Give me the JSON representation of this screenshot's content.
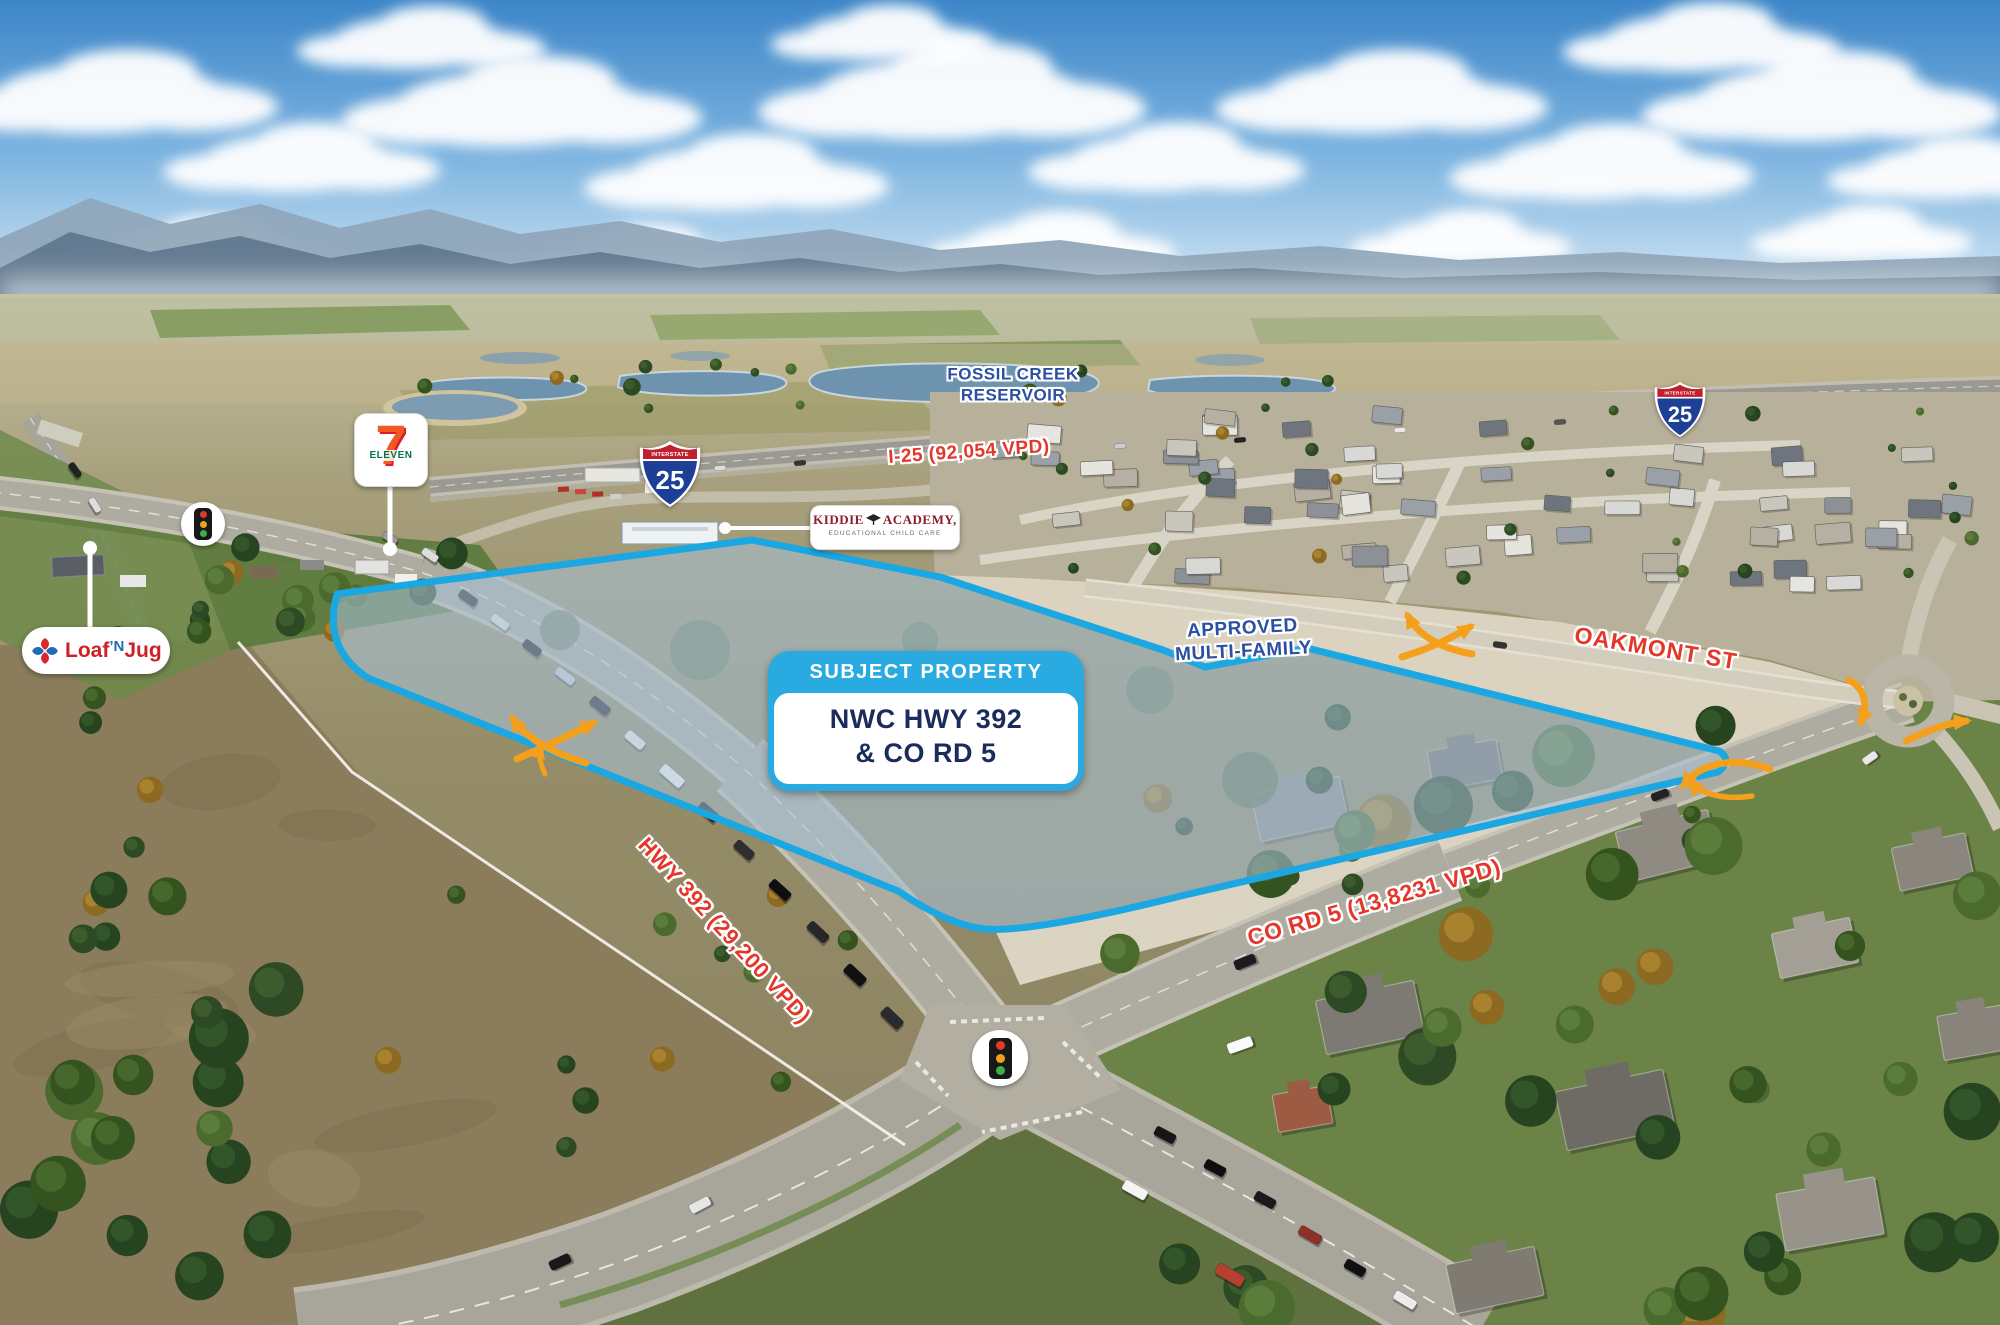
{
  "annotations": {
    "callout": {
      "header": "SUBJECT PROPERTY",
      "line1": "NWC HWY 392",
      "line2": "& CO RD 5"
    },
    "fossil_creek": {
      "line1": "FOSSIL CREEK",
      "line2": "RESERVOIR"
    },
    "i25_traffic": "I-25 (92,054 VPD)",
    "hwy392_traffic": "HWY 392 (29,200 VPD)",
    "cord5_traffic": "CO RD 5 (13,8231 VPD)",
    "oakmont": "OAKMONT ST",
    "approved_mf": {
      "line1": "APPROVED",
      "line2": "MULTI-FAMILY"
    }
  },
  "shield": {
    "top": "INTERSTATE",
    "number": "25"
  },
  "logos": {
    "seven_eleven": {
      "seven": "7",
      "eleven": "ELEVEN"
    },
    "loaf_n_jug": {
      "part1": "Loaf",
      "part2": "’N",
      "part3": "Jug"
    },
    "kiddie_academy": {
      "word1": "KIDDIE",
      "word2": "ACADEMY,",
      "tagline": "EDUCATIONAL CHILD CARE"
    }
  },
  "colors": {
    "boundary_blue": "#1BA7E2",
    "callout_blue": "#29ABE2",
    "label_red": "#E4372C",
    "label_blue": "#2B4FA2",
    "arrow_orange": "#F5A01C"
  }
}
